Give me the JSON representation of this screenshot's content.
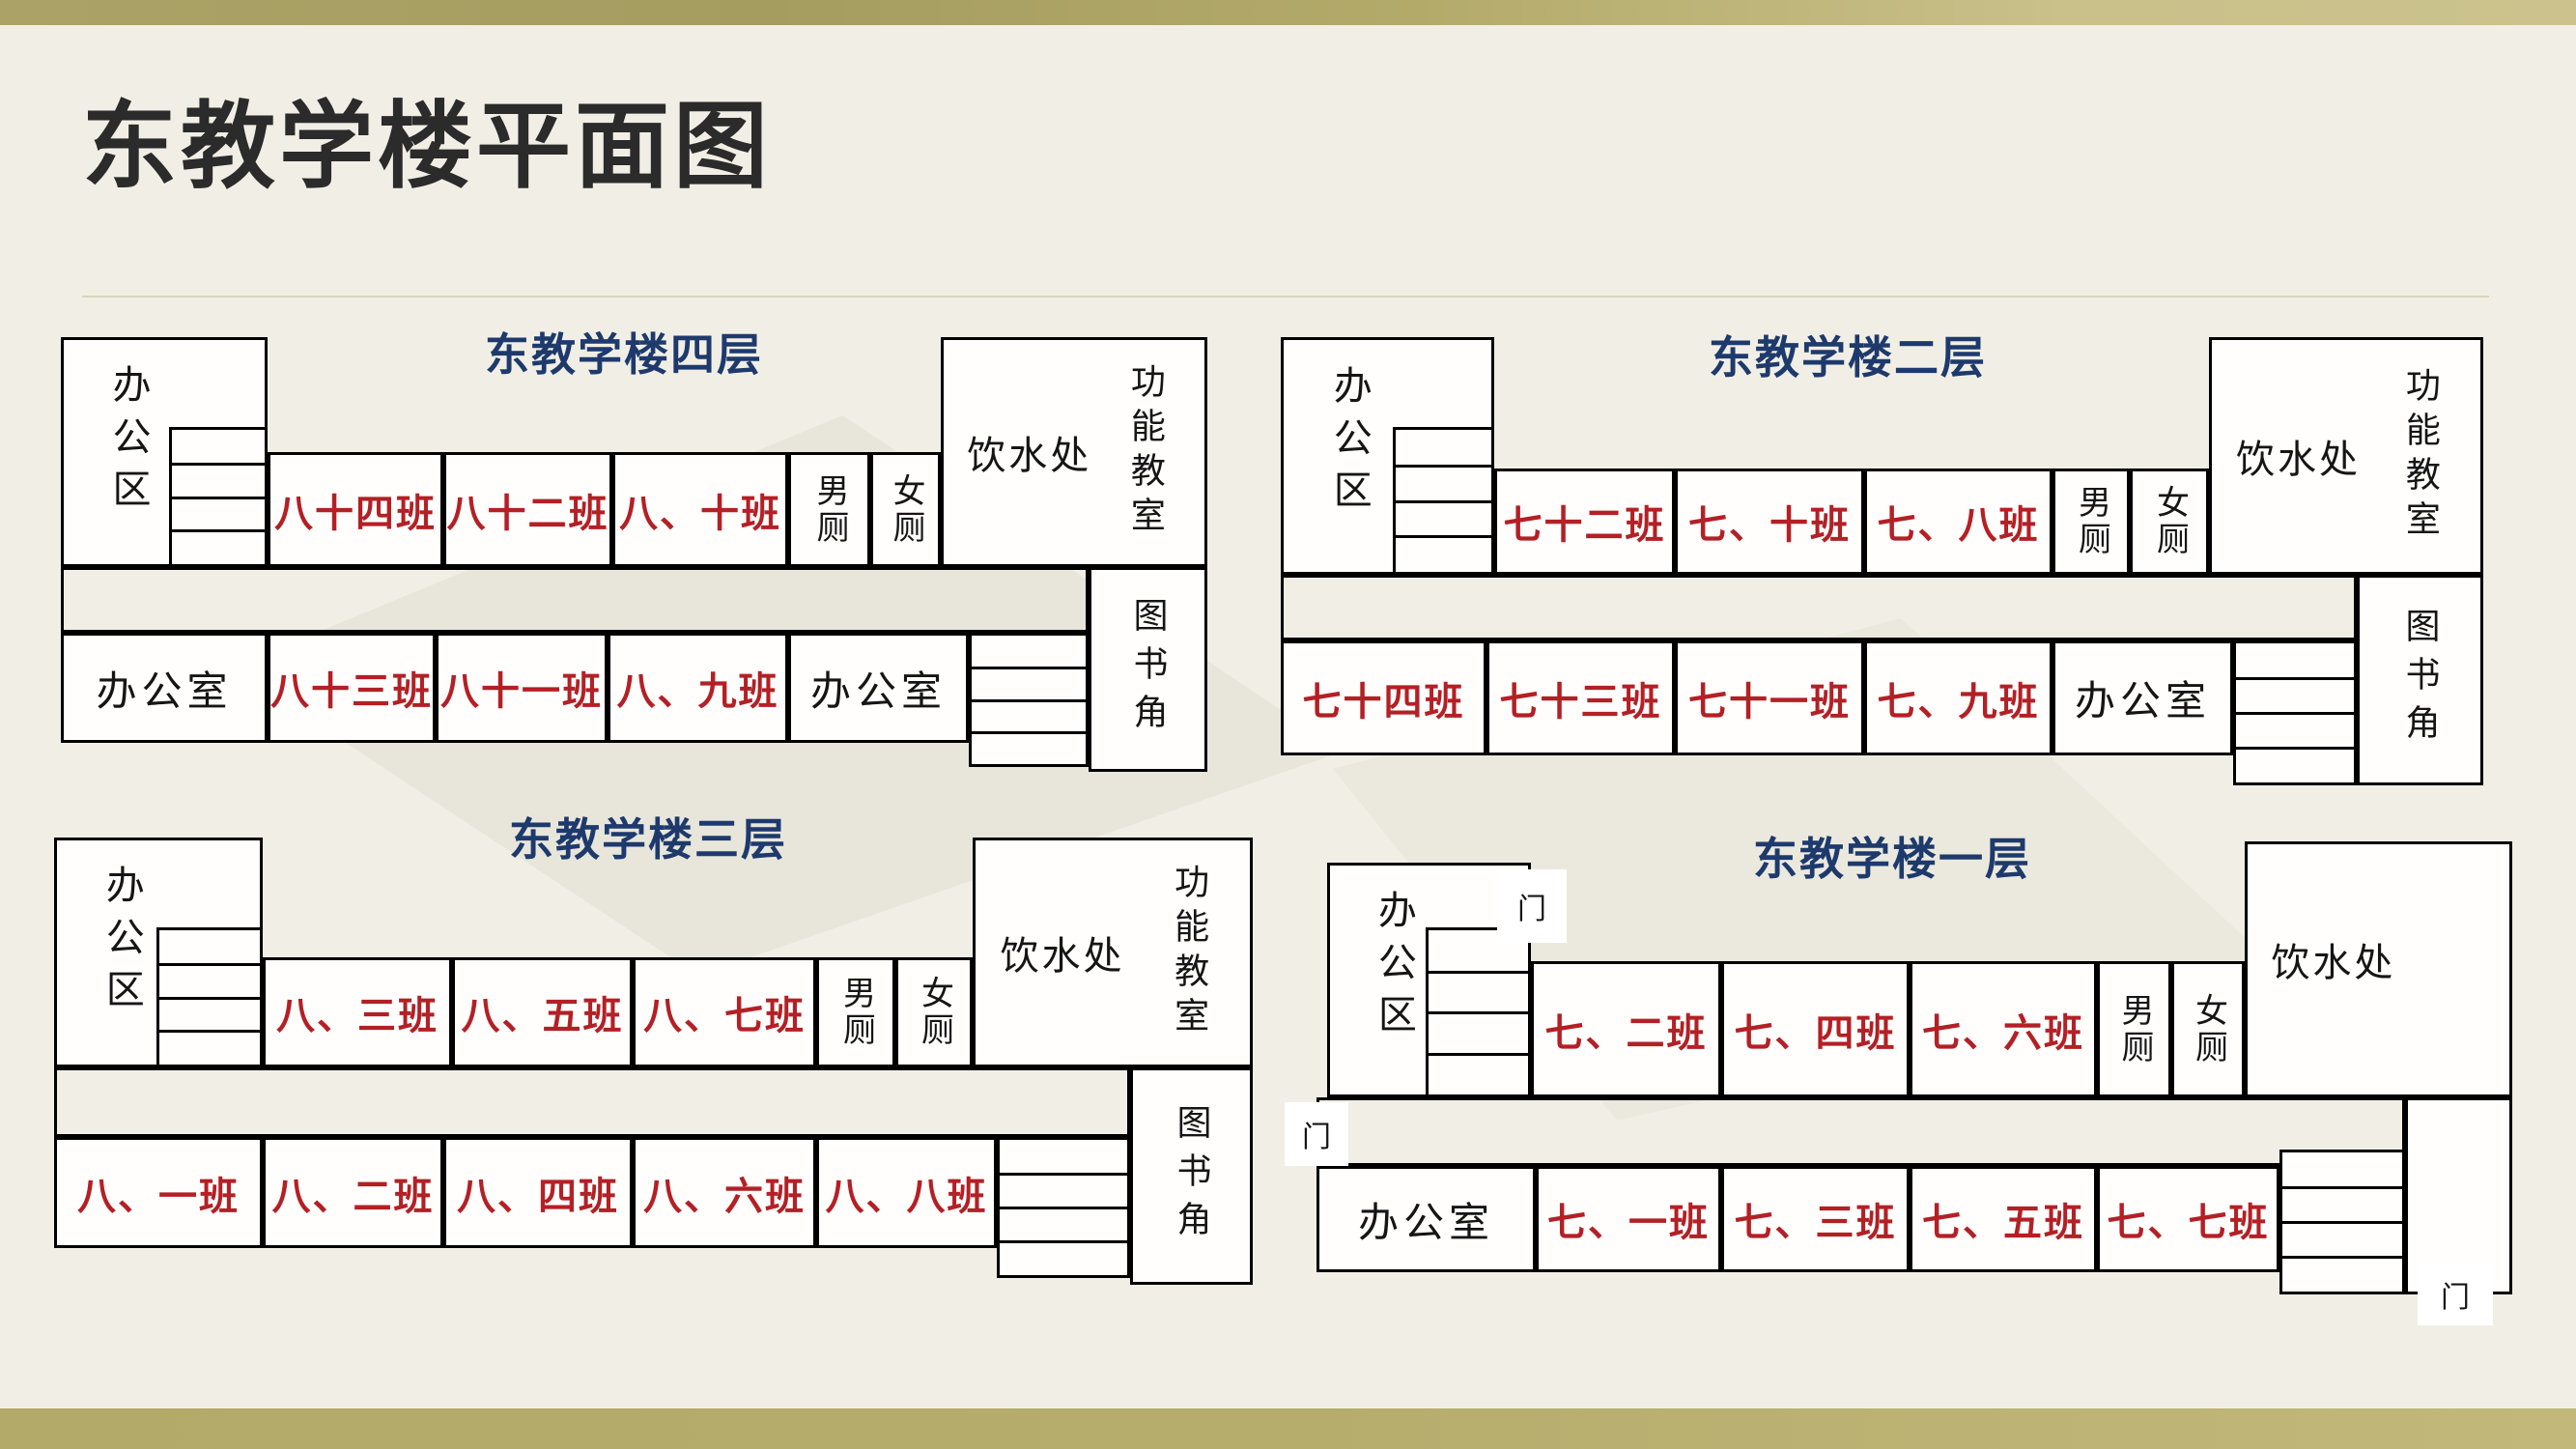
{
  "title": "东教学楼平面图",
  "colors": {
    "background": "#f1efe5",
    "top_bar_left": "#a9a164",
    "top_bar_right": "#cbc28d",
    "bottom_bar": "#b6ac6c",
    "class_red": "#b32025",
    "facility_black": "#151515",
    "subtitle_navy": "#1e3a6d",
    "title_dark": "#2b2b2b",
    "wall": "#000000",
    "room_fill": "#ffffff"
  },
  "floors": [
    {
      "id": "f4",
      "subtitle": "东教学楼四层",
      "office_area": "办公区",
      "top_rooms": [
        {
          "label": "八十四班",
          "type": "class"
        },
        {
          "label": "八十二班",
          "type": "class"
        },
        {
          "label": "八、十班",
          "type": "class"
        },
        {
          "label": "男厕",
          "type": "wc"
        },
        {
          "label": "女厕",
          "type": "wc"
        }
      ],
      "water_station": "饮水处",
      "function_room": "功能教室",
      "bottom_rooms": [
        {
          "label": "办公室",
          "type": "office"
        },
        {
          "label": "八十三班",
          "type": "class"
        },
        {
          "label": "八十一班",
          "type": "class"
        },
        {
          "label": "八、九班",
          "type": "class"
        },
        {
          "label": "办公室",
          "type": "office"
        }
      ],
      "book_corner": "图书角"
    },
    {
      "id": "f2",
      "subtitle": "东教学楼二层",
      "office_area": "办公区",
      "top_rooms": [
        {
          "label": "七十二班",
          "type": "class"
        },
        {
          "label": "七、十班",
          "type": "class"
        },
        {
          "label": "七、八班",
          "type": "class"
        },
        {
          "label": "男厕",
          "type": "wc"
        },
        {
          "label": "女厕",
          "type": "wc"
        }
      ],
      "water_station": "饮水处",
      "function_room": "功能教室",
      "bottom_rooms": [
        {
          "label": "七十四班",
          "type": "class"
        },
        {
          "label": "七十三班",
          "type": "class"
        },
        {
          "label": "七十一班",
          "type": "class"
        },
        {
          "label": "七、九班",
          "type": "class"
        },
        {
          "label": "办公室",
          "type": "office"
        }
      ],
      "book_corner": "图书角"
    },
    {
      "id": "f3",
      "subtitle": "东教学楼三层",
      "office_area": "办公区",
      "top_rooms": [
        {
          "label": "八、三班",
          "type": "class"
        },
        {
          "label": "八、五班",
          "type": "class"
        },
        {
          "label": "八、七班",
          "type": "class"
        },
        {
          "label": "男厕",
          "type": "wc"
        },
        {
          "label": "女厕",
          "type": "wc"
        }
      ],
      "water_station": "饮水处",
      "function_room": "功能教室",
      "bottom_rooms": [
        {
          "label": "八、一班",
          "type": "class"
        },
        {
          "label": "八、二班",
          "type": "class"
        },
        {
          "label": "八、四班",
          "type": "class"
        },
        {
          "label": "八、六班",
          "type": "class"
        },
        {
          "label": "八、八班",
          "type": "class"
        }
      ],
      "book_corner": "图书角"
    },
    {
      "id": "f1",
      "subtitle": "东教学楼一层",
      "office_area": "办公区",
      "top_rooms": [
        {
          "label": "七、二班",
          "type": "class"
        },
        {
          "label": "七、四班",
          "type": "class"
        },
        {
          "label": "七、六班",
          "type": "class"
        },
        {
          "label": "男厕",
          "type": "wc"
        },
        {
          "label": "女厕",
          "type": "wc"
        }
      ],
      "water_station": "饮水处",
      "bottom_rooms": [
        {
          "label": "办公室",
          "type": "office"
        },
        {
          "label": "七、一班",
          "type": "class"
        },
        {
          "label": "七、三班",
          "type": "class"
        },
        {
          "label": "七、五班",
          "type": "class"
        },
        {
          "label": "七、七班",
          "type": "class"
        }
      ],
      "doors": [
        "门",
        "门",
        "门"
      ]
    }
  ]
}
